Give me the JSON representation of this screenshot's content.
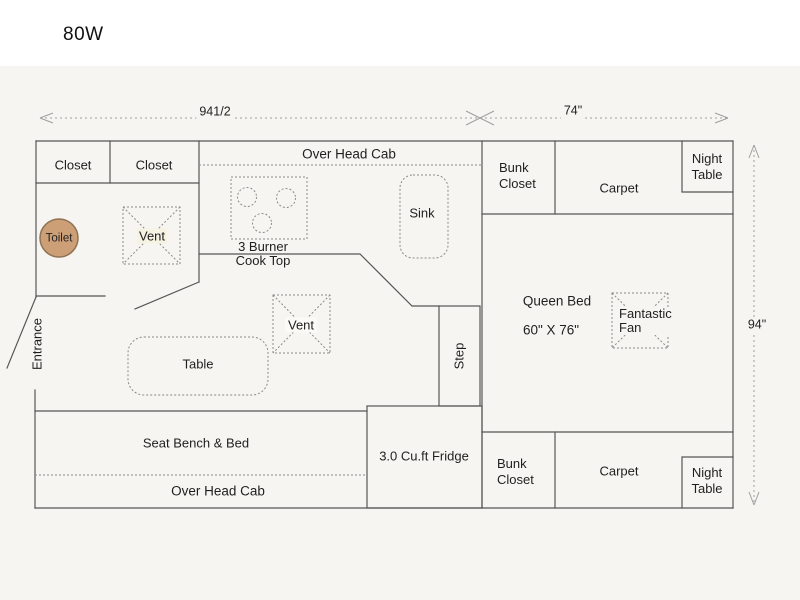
{
  "title": "80W",
  "dimensions": {
    "top_left": "941/2",
    "top_right": "74\"",
    "right": "94\""
  },
  "rooms": {
    "closet_left": "Closet",
    "closet_right": "Closet",
    "overhead_cab_top": "Over Head Cab",
    "bunk_closet_top": {
      "line1": "Bunk",
      "line2": "Closet"
    },
    "carpet_top": "Carpet",
    "night_table_top": {
      "line1": "Night",
      "line2": "Table"
    },
    "queen_bed": {
      "line1": "Queen Bed",
      "line2": "60\" X 76\""
    },
    "fantastic_fan": {
      "line1": "Fantastic",
      "line2": "Fan"
    },
    "entrance": "Entrance",
    "step": "Step",
    "seat_bench": "Seat Bench & Bed",
    "overhead_cab_bottom": "Over Head Cab",
    "fridge": "3.0 Cu.ft Fridge",
    "bunk_closet_bottom": {
      "line1": "Bunk",
      "line2": "Closet"
    },
    "carpet_bottom": "Carpet",
    "night_table_bottom": {
      "line1": "Night",
      "line2": "Table"
    }
  },
  "fixtures": {
    "toilet": "Toilet",
    "vent_galley": "Vent",
    "vent_dinette": "Vent",
    "cooktop": {
      "line1": "3 Burner",
      "line2": "Cook Top"
    },
    "sink": "Sink",
    "table": "Table"
  },
  "colors": {
    "cream_fixture": "#f5f2df",
    "vent_cream": "#f6f3e3",
    "vent_white": "#fbfaf6",
    "toilet_tan": "#cd9f77",
    "toilet_border": "#8f7354",
    "step_gray": "#ebebe8"
  }
}
